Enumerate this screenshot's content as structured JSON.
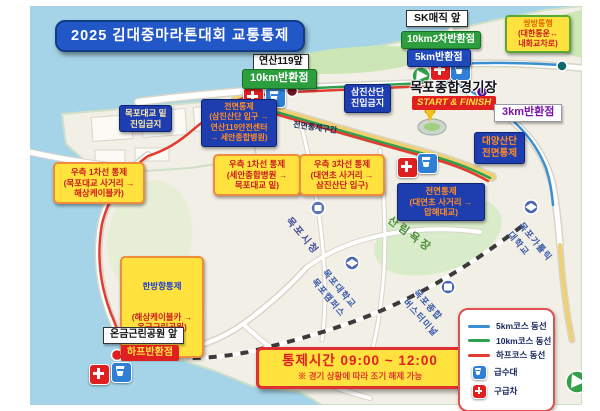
{
  "title": "2025 김대중마라톤대회 교통통제",
  "checkpoints": {
    "sk_magic": "SK매직 앞",
    "km10_2nd": "10km2차반환점",
    "km5": "5km반환점",
    "yeonsan119": "연산119앞",
    "km10": "10km반환점",
    "km3": "3km반환점",
    "stadium": "목포종합경기장",
    "start_finish": "START & FINISH",
    "ongeum_front": "온금근린공원 앞",
    "half_turn": "하프반환점"
  },
  "controls": {
    "two_way_title": "쌍방통행",
    "two_way_body": "(대한통운↔\n내화교차로)",
    "samjin_no_entry": "삼진산단\n진입금지",
    "daeyang": "대양산단\n전면통제",
    "bridge_no_entry": "목포대교 밑\n진입금지",
    "full_west": "전면통제\n(삼진산단 입구 →\n연산119안전센터\n→ 세안종합병원)",
    "full_section": "전면통제구간",
    "right1_west": "우측 1차선 통제\n(목포대교 사거리 →\n해상케이블카)",
    "right1_mid": "우측 1차선 통제\n(세안종합병원 →\n목포대교 밑)",
    "right3": "우측 3차선 통제\n(대연초 사거리 →\n삼진산단 입구)",
    "full_east": "전면통제\n(대연초 사거리 →\n압해대교)",
    "one_way_title": "한방향통제",
    "one_way_body": "(해상케이블카 →\n온금근린공원)",
    "time_title": "통제시간 09:00 ~ 12:00",
    "time_sub": "※ 경기 상황에 따라 조기 해제 가능"
  },
  "legend": {
    "items": [
      {
        "label": "5km코스 동선",
        "color": "#3a8fd0"
      },
      {
        "label": "10km코스 동선",
        "color": "#2fa04f"
      },
      {
        "label": "하프코스 동선",
        "color": "#e23c30"
      },
      {
        "label": "급수대",
        "icon": "water-station"
      },
      {
        "label": "구급차",
        "icon": "ambulance"
      }
    ]
  },
  "places": {
    "cityhall": "목포시청",
    "forest": "산림욕장",
    "university": "목포대학교\n목포캠퍼스",
    "bus_terminal": "목포종합\n버스터미널",
    "station": "목포역",
    "catholic_univ": "목포가톨릭\n대학교"
  },
  "colors": {
    "sea": "#a5d4e8",
    "land": "#f2efe6",
    "route_5km": "#3a8fd0",
    "route_10km": "#2fa04f",
    "route_half": "#e23c30",
    "control_navy": "#1e3dae",
    "control_yellow": "#ffe23e"
  }
}
